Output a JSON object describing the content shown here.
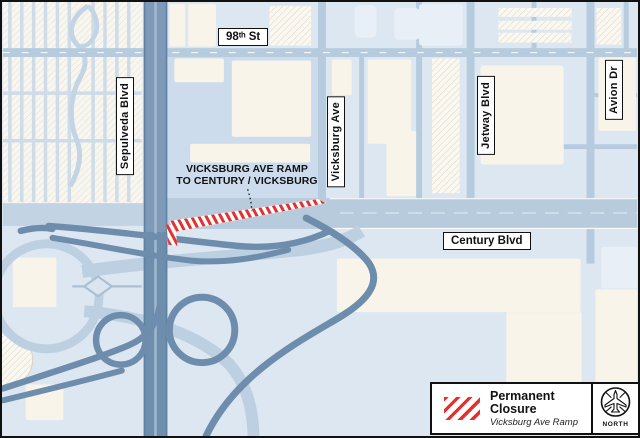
{
  "map": {
    "street_labels": [
      {
        "name": "98th-st",
        "text": "98ᵗʰ St"
      },
      {
        "name": "sepulveda-blvd",
        "text": "Sepulveda Blvd"
      },
      {
        "name": "vicksburg-ave",
        "text": "Vicksburg Ave"
      },
      {
        "name": "jetway-blvd",
        "text": "Jetway Blvd"
      },
      {
        "name": "avion-dr",
        "text": "Avion Dr"
      },
      {
        "name": "century-blvd",
        "text": "Century Blvd"
      }
    ],
    "closure_annotation": {
      "line1": "VICKSBURG AVE RAMP",
      "line2": "TO CENTURY / VICKSBURG"
    }
  },
  "legend": {
    "swatch_icon": "red-diagonal-hatch",
    "title_line1": "Permanent",
    "title_line2": "Closure",
    "subtitle": "Vicksburg Ave Ramp"
  },
  "compass": {
    "icon": "airplane-compass",
    "label": "NORTH"
  },
  "colors": {
    "closure_red": "#e5302e",
    "map_background": "#dde7f2",
    "freeway_blue": "#7e9ab8",
    "ramp_blue": "#6e8dac",
    "minor_road_blue": "#b6ccde",
    "building_cream": "#f9f4e9"
  }
}
